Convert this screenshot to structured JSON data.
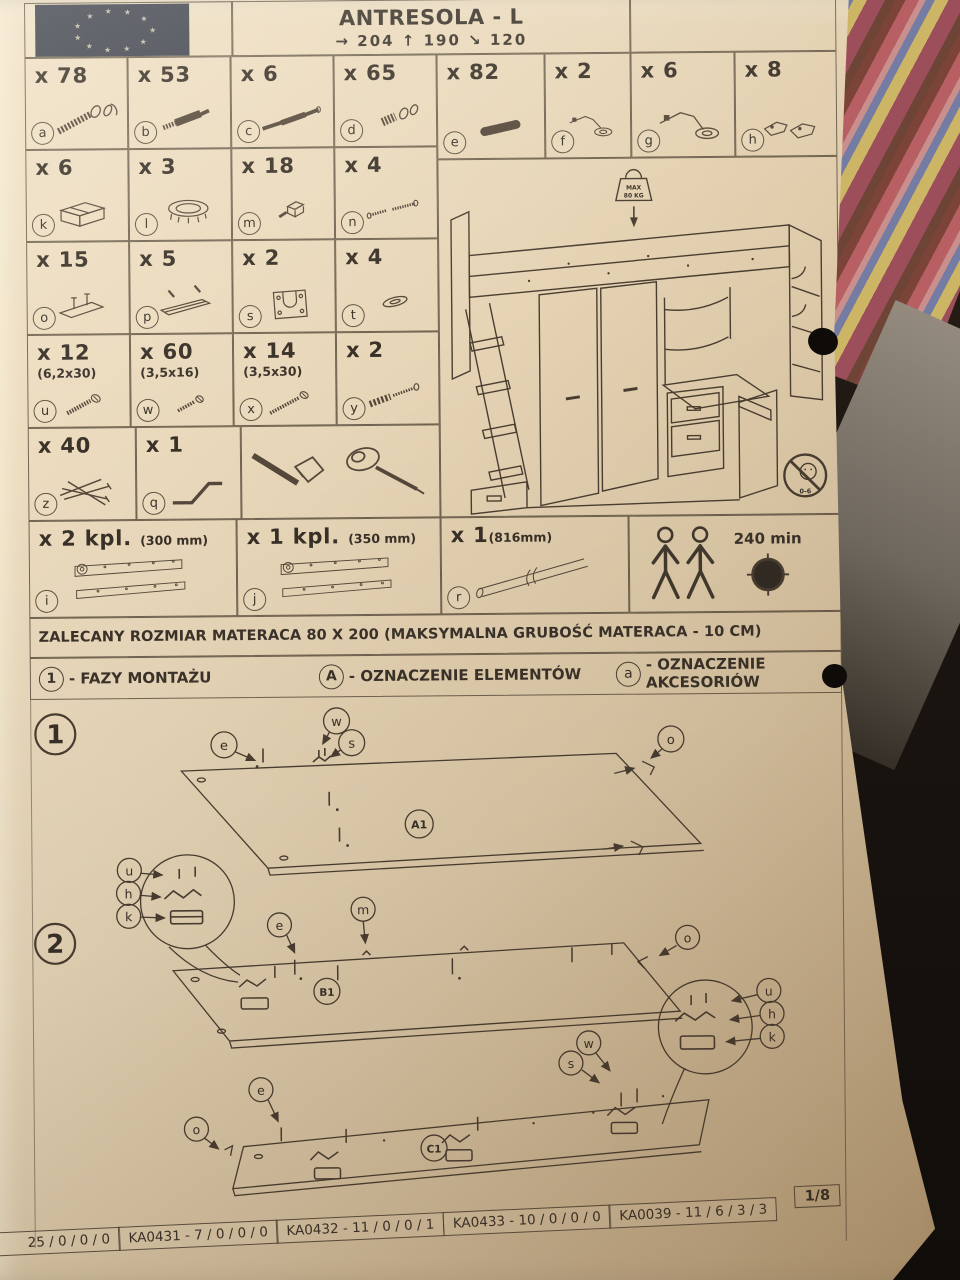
{
  "colors": {
    "paper": "#e8d6b8",
    "ink": "#4a3e31",
    "text": "#393128",
    "flag_bg": "#3f444e",
    "photo_bg": "#14100c"
  },
  "header": {
    "logo": "eu-flag",
    "title": "ANTRESOLA - L",
    "dims": "→ 204  ↑ 190  ↘ 120"
  },
  "parts": {
    "a": {
      "label": "a",
      "qty": "x 78",
      "icon": "confirmat-screw"
    },
    "b": {
      "label": "b",
      "qty": "x 53",
      "icon": "connector-bolt"
    },
    "c": {
      "label": "c",
      "qty": "x 6",
      "icon": "metal-rod"
    },
    "d": {
      "label": "d",
      "qty": "x 65",
      "icon": "cam-lock"
    },
    "e": {
      "label": "e",
      "qty": "x 82",
      "icon": "wooden-dowel"
    },
    "f": {
      "label": "f",
      "qty": "x 2",
      "icon": "cabinet-hinge"
    },
    "g": {
      "label": "g",
      "qty": "x 6",
      "icon": "cabinet-hinge"
    },
    "h": {
      "label": "h",
      "qty": "x 8",
      "icon": "mounting-bracket"
    },
    "k": {
      "label": "k",
      "qty": "x 6",
      "icon": "runner-block"
    },
    "l": {
      "label": "l",
      "qty": "x 3",
      "icon": "round-grommet"
    },
    "m": {
      "label": "m",
      "qty": "x 18",
      "icon": "shelf-support"
    },
    "n": {
      "label": "n",
      "qty": "x 4",
      "icon": "machine-screws"
    },
    "o": {
      "label": "o",
      "qty": "x 15",
      "icon": "flat-connector"
    },
    "p": {
      "label": "p",
      "qty": "x 5",
      "icon": "edge-strip"
    },
    "s": {
      "label": "s",
      "qty": "x 2",
      "icon": "u-bracket"
    },
    "t": {
      "label": "t",
      "qty": "x 4",
      "icon": "washer"
    },
    "u": {
      "label": "u",
      "qty": "x 12",
      "note": "(6,2x30)",
      "icon": "wood-screw"
    },
    "w": {
      "label": "w",
      "qty": "x 60",
      "note": "(3,5x16)",
      "icon": "wood-screw"
    },
    "x": {
      "label": "x",
      "qty": "x 14",
      "note": "(3,5x30)",
      "icon": "wood-screw"
    },
    "y": {
      "label": "y",
      "qty": "x 2",
      "icon": "wall-plug-screw"
    },
    "z": {
      "label": "z",
      "qty": "x 40",
      "icon": "nails"
    },
    "q": {
      "label": "q",
      "qty": "x 1",
      "icon": "allen-key"
    },
    "i": {
      "label": "i",
      "qty": "x 2 kpl.",
      "note": "(300 mm)",
      "icon": "drawer-slides"
    },
    "j": {
      "label": "j",
      "qty": "x 1 kpl.",
      "note": "(350 mm)",
      "icon": "drawer-slides"
    },
    "r": {
      "label": "r",
      "qty": "x 1",
      "note": "(816mm)",
      "icon": "round-tube"
    }
  },
  "tools": [
    "hammer",
    "screwdriver"
  ],
  "assembly": {
    "persons": "2",
    "duration": "240 min"
  },
  "furniture_diagram": {
    "max_load_line1": "MAX",
    "max_load_line2": "80 KG",
    "age_restriction": "0-6"
  },
  "mattress_note": "ZALECANY ROZMIAR MATERACA 80 X 200 (MAKSYMALNA GRUBOŚĆ MATERACA - 10 CM)",
  "legend": {
    "phase_symbol": "1",
    "phase_text": "- FAZY MONTAŻU",
    "element_symbol": "A",
    "element_text": "- OZNACZENIE ELEMENTÓW",
    "accessory_symbol": "a",
    "accessory_text": "- OZNACZENIE AKCESORIÓW"
  },
  "steps": {
    "one": {
      "num": "1",
      "panel": "A1",
      "c_e": "e",
      "c_w": "w",
      "c_s": "s",
      "c_o": "o"
    },
    "two": {
      "num": "2",
      "panelB": "B1",
      "panelC": "C1",
      "c_u": "u",
      "c_h": "h",
      "c_k": "k",
      "c_e": "e",
      "c_m": "m",
      "c_o": "o",
      "c_u2": "u",
      "c_h2": "h",
      "c_k2": "k",
      "c_w": "w",
      "c_s": "s",
      "c_e2": "e",
      "c_o2": "o"
    }
  },
  "footer": {
    "cells": [
      "25 / 0 / 0 / 0",
      "KA0431 - 7 / 0 / 0 / 0",
      "KA0432 - 11 / 0 / 0 / 1",
      "KA0433 - 10 / 0 / 0 / 0",
      "KA0039 - 11 / 6 / 3 / 3"
    ],
    "page": "1/8"
  }
}
